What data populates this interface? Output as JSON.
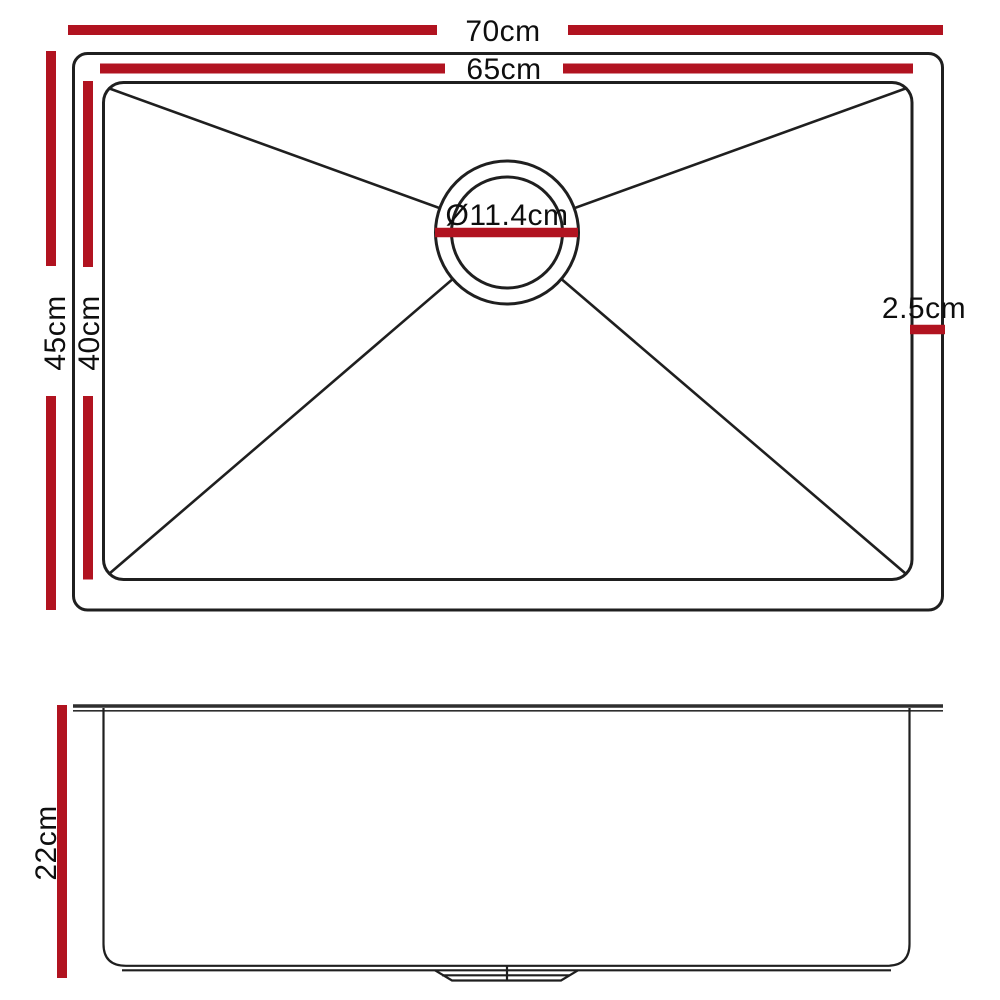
{
  "colors": {
    "dimension_line_red": "#b11320",
    "outline_black": "#1f1f1f"
  },
  "top_view": {
    "labels": {
      "outer_width": "70cm",
      "inner_width": "65cm",
      "outer_depth": "45cm",
      "inner_depth": "40cm",
      "drain_diameter": "Ø11.4cm",
      "rim_offset": "2.5cm"
    }
  },
  "side_view": {
    "labels": {
      "bowl_depth": "22cm"
    }
  }
}
